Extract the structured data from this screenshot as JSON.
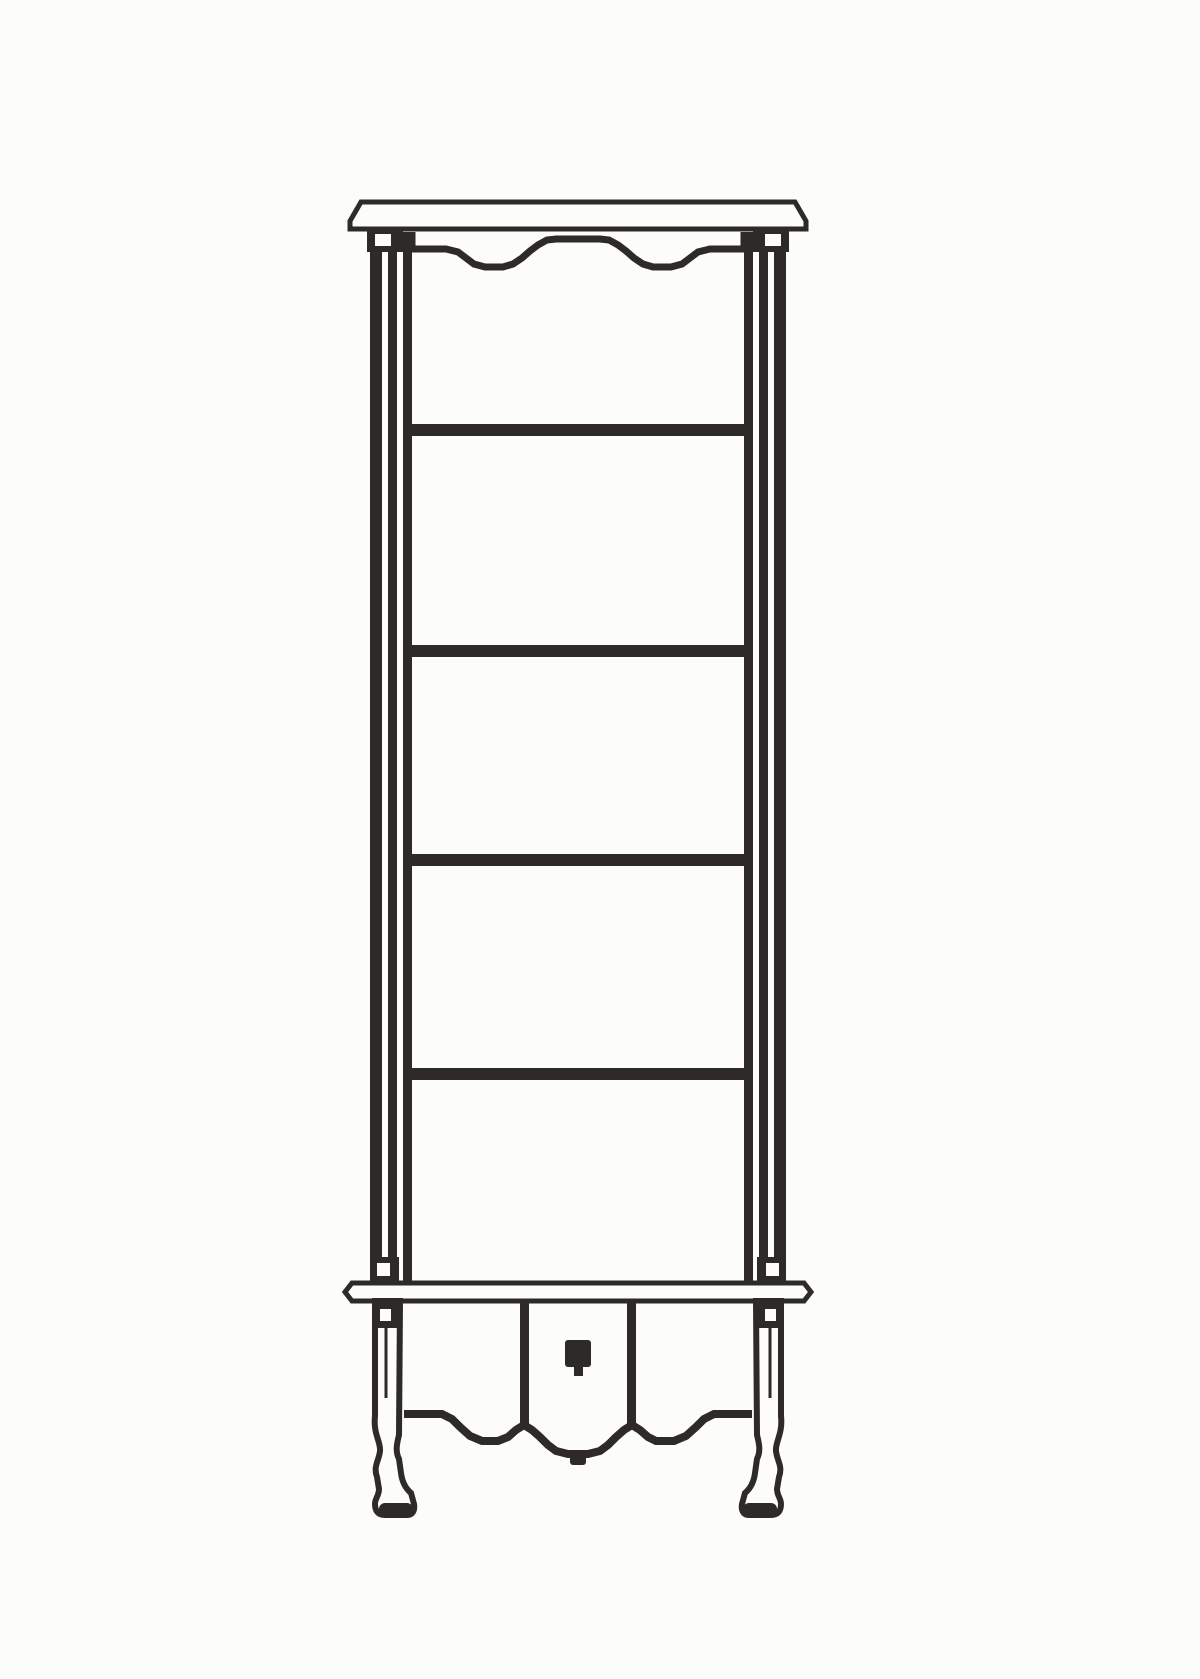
{
  "figure": {
    "name": "display-cabinet-line-drawing",
    "description": "Black-and-white technical line drawing of a tall five-tier display cabinet: overhanging cornice, scalloped top valance, four interior shelves, lower base board with center drawer panel and square knob, scalloped base apron and carved cabriole legs",
    "canvas": {
      "w": 1200,
      "h": 1679
    },
    "paper": "#fcfcfb",
    "ink": "#2e2a27",
    "elements": [
      {
        "name": "cornice-board",
        "type": "polygon",
        "pts": [
          [
            361,
            202
          ],
          [
            795,
            202
          ],
          [
            806,
            221
          ],
          [
            806,
            229
          ],
          [
            350,
            229
          ],
          [
            350,
            221
          ]
        ],
        "fill": "paper",
        "stroke": "ink",
        "sw": 5
      },
      {
        "name": "left-stile-outer-line",
        "type": "rect",
        "x": 370,
        "y": 229,
        "w": 12,
        "h": 1054,
        "fill": "ink"
      },
      {
        "name": "left-stile-inner-line",
        "type": "rect",
        "x": 388,
        "y": 229,
        "w": 9,
        "h": 1054,
        "fill": "ink"
      },
      {
        "name": "left-interior-frame-line",
        "type": "rect",
        "x": 403,
        "y": 232,
        "w": 9,
        "h": 1051,
        "fill": "ink"
      },
      {
        "name": "right-stile-outer-line",
        "type": "rect",
        "x": 774,
        "y": 229,
        "w": 12,
        "h": 1054,
        "fill": "ink"
      },
      {
        "name": "right-stile-inner-line",
        "type": "rect",
        "x": 759,
        "y": 229,
        "w": 9,
        "h": 1054,
        "fill": "ink"
      },
      {
        "name": "right-interior-frame-line",
        "type": "rect",
        "x": 744,
        "y": 232,
        "w": 9,
        "h": 1051,
        "fill": "ink"
      },
      {
        "name": "left-capital-block",
        "type": "rect",
        "x": 367,
        "y": 229,
        "w": 36,
        "h": 23,
        "fill": "ink"
      },
      {
        "name": "left-capital-rosette",
        "type": "rect",
        "x": 375,
        "y": 234,
        "w": 16,
        "h": 12,
        "fill": "paper"
      },
      {
        "name": "right-capital-block",
        "type": "rect",
        "x": 753,
        "y": 229,
        "w": 36,
        "h": 23,
        "fill": "ink"
      },
      {
        "name": "right-capital-rosette",
        "type": "rect",
        "x": 765,
        "y": 234,
        "w": 16,
        "h": 12,
        "fill": "paper"
      },
      {
        "name": "top-valance",
        "type": "polyline",
        "pts": [
          [
            412,
            232
          ],
          [
            412,
            249
          ],
          [
            446,
            249
          ],
          [
            458,
            252
          ],
          [
            466,
            258
          ],
          [
            474,
            264
          ],
          [
            485,
            267
          ],
          [
            503,
            267
          ],
          [
            513,
            264
          ],
          [
            522,
            258
          ],
          [
            530,
            251
          ],
          [
            538,
            245
          ],
          [
            547,
            240
          ],
          [
            556,
            239
          ],
          [
            600,
            239
          ],
          [
            609,
            240
          ],
          [
            618,
            245
          ],
          [
            626,
            251
          ],
          [
            634,
            258
          ],
          [
            643,
            264
          ],
          [
            653,
            267
          ],
          [
            671,
            267
          ],
          [
            682,
            264
          ],
          [
            690,
            258
          ],
          [
            698,
            252
          ],
          [
            710,
            249
          ],
          [
            744,
            249
          ],
          [
            744,
            232
          ]
        ],
        "stroke": "ink",
        "sw": 7
      },
      {
        "name": "shelf-1",
        "type": "rect",
        "x": 403,
        "y": 424,
        "w": 350,
        "h": 12,
        "fill": "ink"
      },
      {
        "name": "shelf-2",
        "type": "rect",
        "x": 403,
        "y": 645,
        "w": 350,
        "h": 12,
        "fill": "ink"
      },
      {
        "name": "shelf-3",
        "type": "rect",
        "x": 403,
        "y": 854,
        "w": 350,
        "h": 12,
        "fill": "ink"
      },
      {
        "name": "shelf-4",
        "type": "rect",
        "x": 403,
        "y": 1068,
        "w": 350,
        "h": 12,
        "fill": "ink"
      },
      {
        "name": "left-corbel-block",
        "type": "rect",
        "x": 370,
        "y": 1257,
        "w": 29,
        "h": 26,
        "fill": "ink"
      },
      {
        "name": "left-corbel-rosette",
        "type": "rect",
        "x": 377,
        "y": 1263,
        "w": 13,
        "h": 13,
        "fill": "paper"
      },
      {
        "name": "right-corbel-block",
        "type": "rect",
        "x": 757,
        "y": 1257,
        "w": 29,
        "h": 26,
        "fill": "ink"
      },
      {
        "name": "right-corbel-rosette",
        "type": "rect",
        "x": 766,
        "y": 1263,
        "w": 13,
        "h": 13,
        "fill": "paper"
      },
      {
        "name": "base-board",
        "type": "polygon",
        "pts": [
          [
            352,
            1283
          ],
          [
            804,
            1283
          ],
          [
            811,
            1292
          ],
          [
            804,
            1301
          ],
          [
            352,
            1301
          ],
          [
            345,
            1292
          ]
        ],
        "fill": "paper",
        "stroke": "ink",
        "sw": 5
      },
      {
        "name": "left-leg",
        "type": "path",
        "d": "M375,1301 L375,1416 C373,1434 381,1442 380,1451 C379,1461 373,1466 377,1477 L379,1489 C379,1496 375,1498 375,1504 C375,1512 379,1515 385,1515 L407,1515 C413,1515 415,1510 414,1504 L411,1493 C405,1488 402,1481 401,1473 L399,1459 C395,1451 397,1443 399,1435 L400,1301 Z",
        "fill": "paper",
        "stroke": "ink",
        "sw": 6
      },
      {
        "name": "right-leg",
        "type": "path",
        "d": "M781,1301 L781,1416 C783,1434 775,1442 776,1451 C777,1461 783,1466 779,1477 L777,1489 C777,1496 781,1498 781,1504 C781,1512 777,1515 771,1515 L749,1515 C743,1515 741,1510 742,1504 L745,1493 C751,1488 754,1481 755,1473 L757,1459 C761,1451 759,1443 757,1435 L756,1301 Z",
        "fill": "paper",
        "stroke": "ink",
        "sw": 6
      },
      {
        "name": "left-leg-flute",
        "type": "line",
        "x1": 386,
        "y1": 1312,
        "x2": 386,
        "y2": 1398,
        "stroke": "ink",
        "sw": 3
      },
      {
        "name": "right-leg-flute",
        "type": "line",
        "x1": 770,
        "y1": 1312,
        "x2": 770,
        "y2": 1398,
        "stroke": "ink",
        "sw": 3
      },
      {
        "name": "left-foot-pad",
        "type": "rect",
        "x": 379,
        "y": 1503,
        "w": 34,
        "h": 12,
        "rx": 6,
        "fill": "ink"
      },
      {
        "name": "right-foot-pad",
        "type": "rect",
        "x": 743,
        "y": 1503,
        "w": 34,
        "h": 12,
        "rx": 6,
        "fill": "ink"
      },
      {
        "name": "left-bracket-block",
        "type": "rect",
        "x": 375,
        "y": 1303,
        "w": 23,
        "h": 25,
        "fill": "ink"
      },
      {
        "name": "left-bracket-rosette",
        "type": "rect",
        "x": 380,
        "y": 1309,
        "w": 11,
        "h": 12,
        "fill": "paper"
      },
      {
        "name": "right-bracket-block",
        "type": "rect",
        "x": 758,
        "y": 1303,
        "w": 23,
        "h": 25,
        "fill": "ink"
      },
      {
        "name": "right-bracket-rosette",
        "type": "rect",
        "x": 765,
        "y": 1309,
        "w": 11,
        "h": 12,
        "fill": "paper"
      },
      {
        "name": "left-panel-divider",
        "type": "rect",
        "x": 520,
        "y": 1301,
        "w": 9,
        "h": 126,
        "fill": "ink"
      },
      {
        "name": "right-panel-divider",
        "type": "rect",
        "x": 627,
        "y": 1301,
        "w": 9,
        "h": 126,
        "fill": "ink"
      },
      {
        "name": "base-apron",
        "type": "polyline",
        "pts": [
          [
            404,
            1414
          ],
          [
            442,
            1414
          ],
          [
            452,
            1419
          ],
          [
            460,
            1427
          ],
          [
            470,
            1436
          ],
          [
            482,
            1441
          ],
          [
            498,
            1441
          ],
          [
            508,
            1437
          ],
          [
            516,
            1430
          ],
          [
            524,
            1425
          ],
          [
            532,
            1430
          ],
          [
            540,
            1437
          ],
          [
            548,
            1445
          ],
          [
            556,
            1451
          ],
          [
            568,
            1454
          ],
          [
            588,
            1454
          ],
          [
            600,
            1451
          ],
          [
            608,
            1445
          ],
          [
            616,
            1437
          ],
          [
            624,
            1430
          ],
          [
            632,
            1425
          ],
          [
            640,
            1430
          ],
          [
            648,
            1437
          ],
          [
            656,
            1441
          ],
          [
            674,
            1441
          ],
          [
            686,
            1436
          ],
          [
            696,
            1427
          ],
          [
            704,
            1419
          ],
          [
            714,
            1414
          ],
          [
            752,
            1414
          ]
        ],
        "stroke": "ink",
        "sw": 8
      },
      {
        "name": "apron-center-pendant",
        "type": "rect",
        "x": 570,
        "y": 1450,
        "w": 16,
        "h": 15,
        "rx": 3,
        "fill": "ink"
      },
      {
        "name": "drawer-knob",
        "type": "rect",
        "x": 565,
        "y": 1340,
        "w": 26,
        "h": 27,
        "rx": 3,
        "fill": "ink"
      },
      {
        "name": "knob-drop",
        "type": "rect",
        "x": 574,
        "y": 1367,
        "w": 9,
        "h": 9,
        "fill": "ink"
      }
    ]
  }
}
